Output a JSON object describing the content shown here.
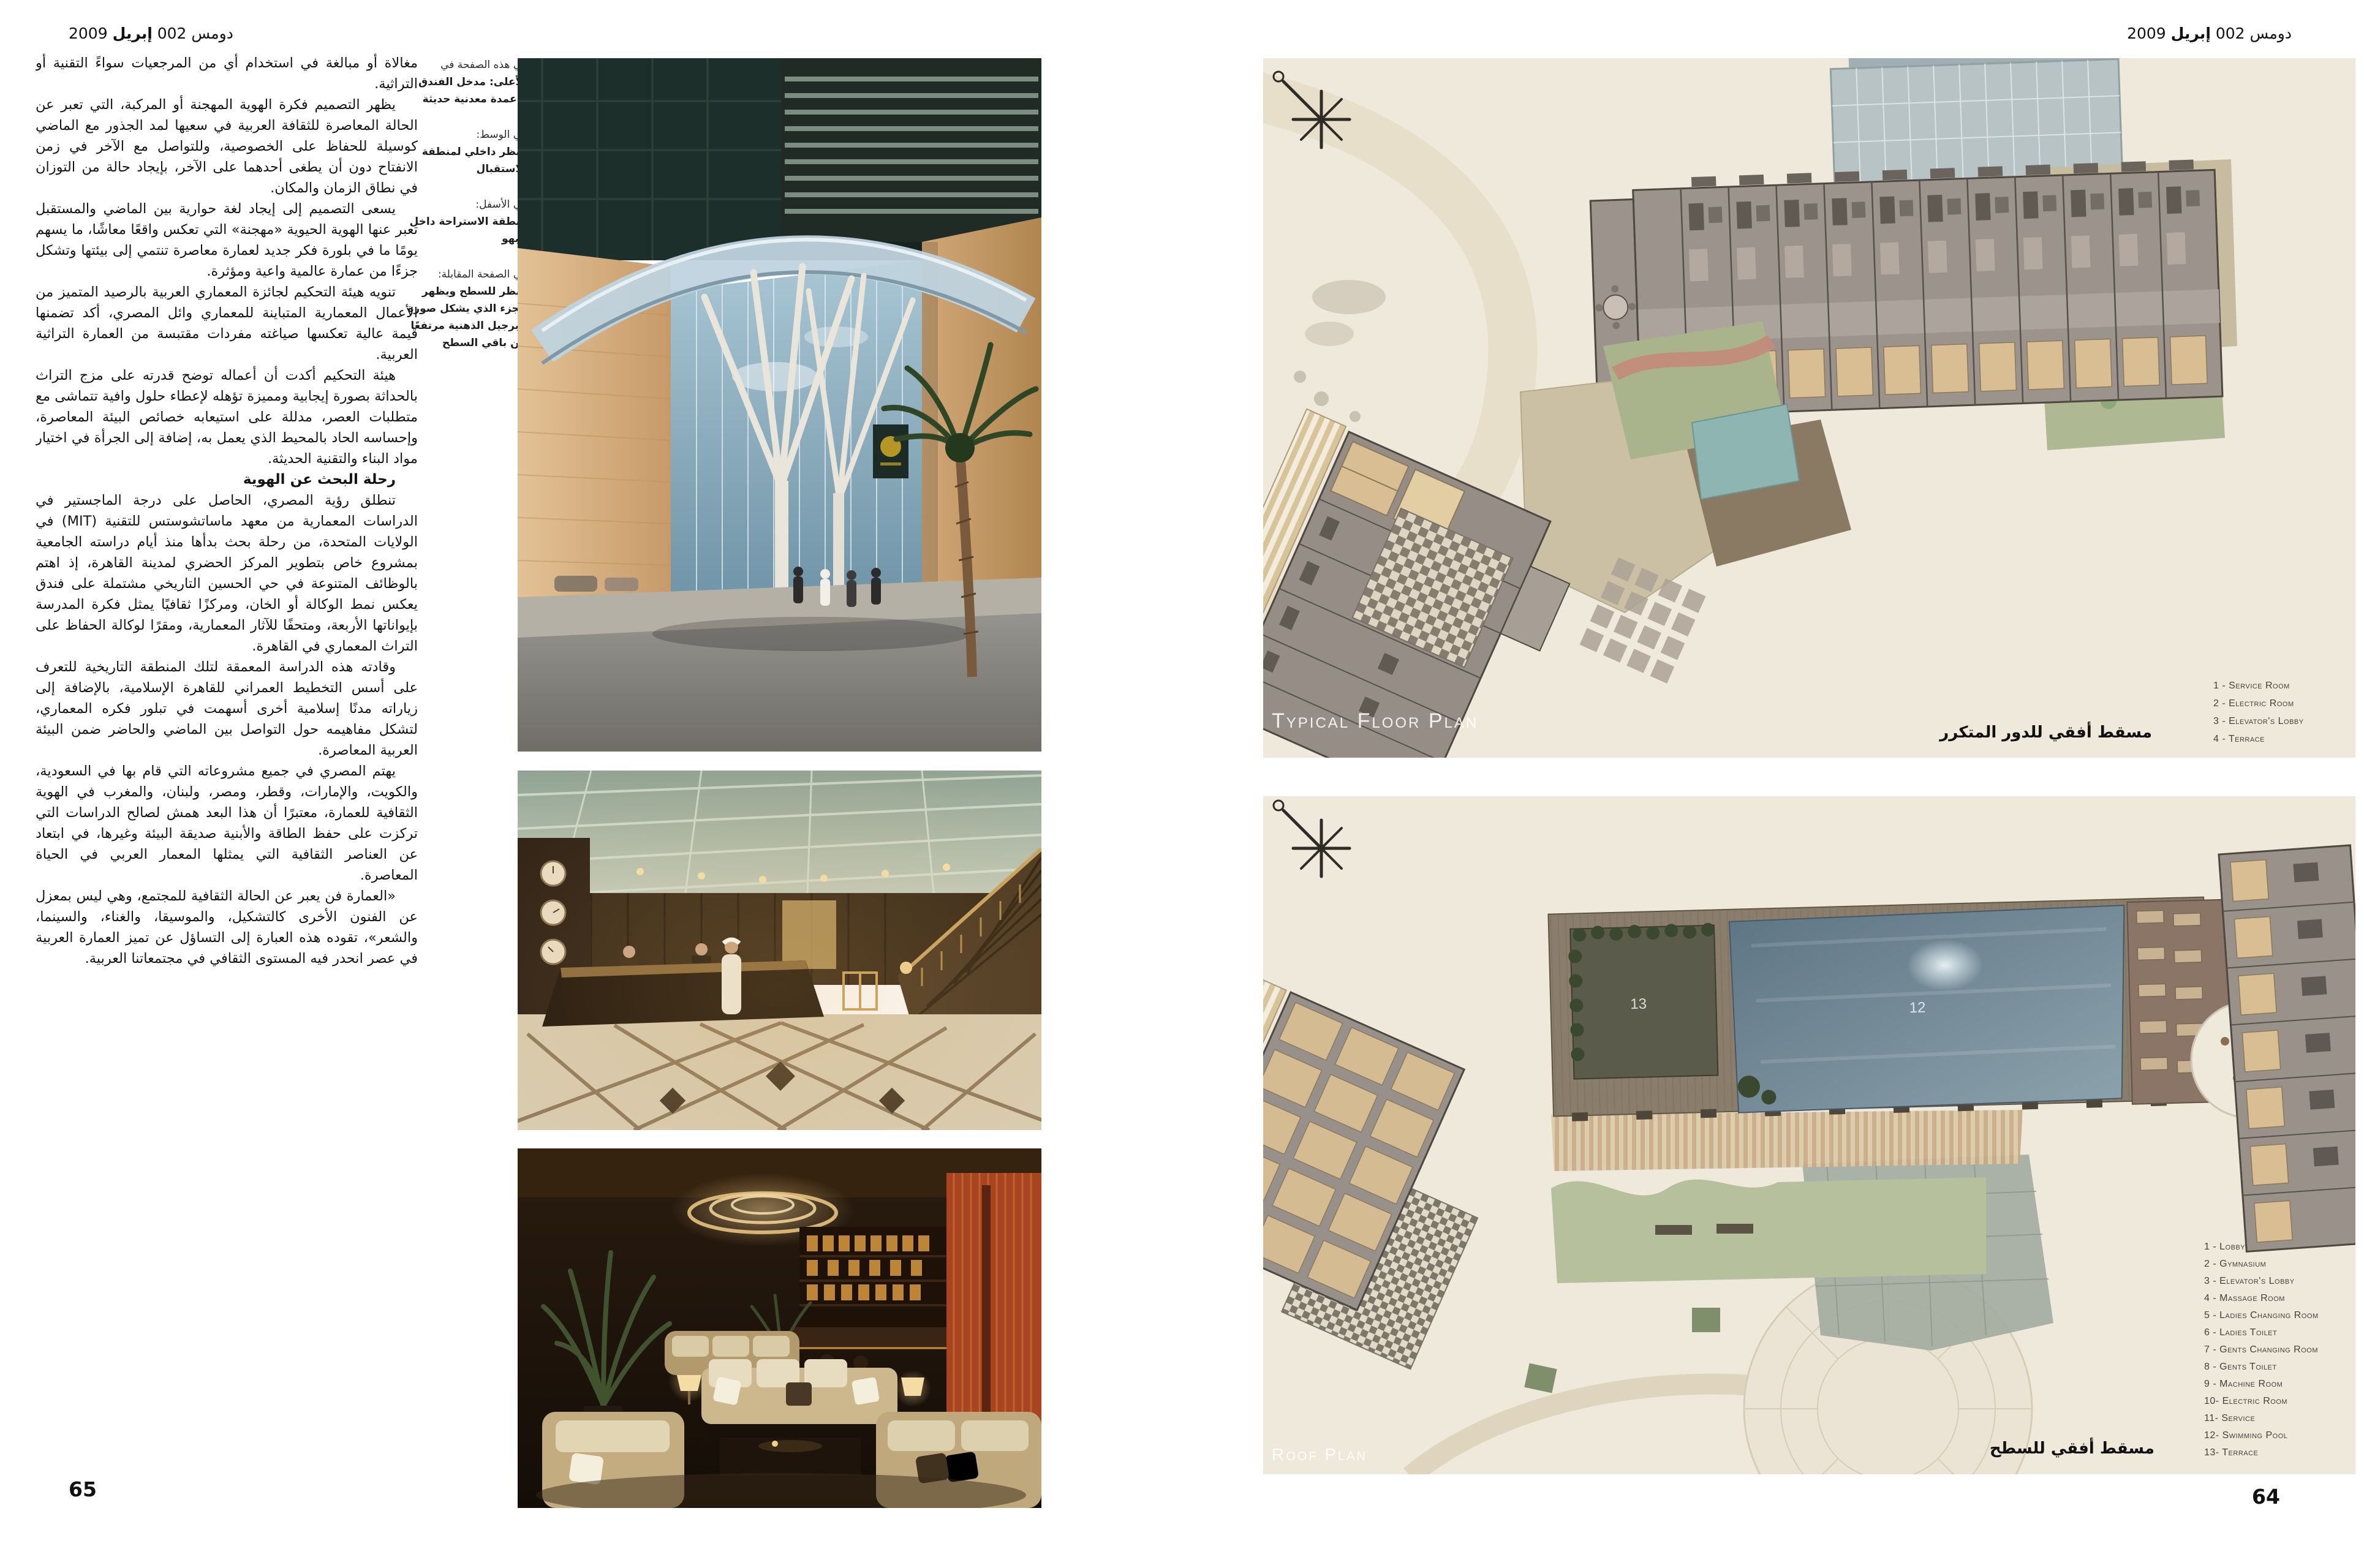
{
  "page": {
    "header": {
      "brand": "دومس",
      "issue": "002",
      "month": "إبريل",
      "year": "2009"
    },
    "left_page_number": "65",
    "right_page_number": "64"
  },
  "article": {
    "intro_paragraphs": [
      "مغالاة أو مبالغة في استخدام أي من المرجعيات سواءً التقنية أو التراثية.",
      "يظهر التصميم فكرة الهوية المهجنة أو المركبة، التي تعبر عن الحالة المعاصرة للثقافة العربية في سعيها لمد الجذور مع الماضي كوسيلة للحفاظ على الخصوصية، وللتواصل مع الآخر في زمن الانفتاح دون أن يطغى أحدهما على الآخر، بإيجاد حالة من التوزان في نطاق الزمان والمكان.",
      "يسعى التصميم إلى إيجاد لغة حوارية بين الماضي والمستقبل تعبر عنها الهوية الحيوية «مهجنة» التي تعكس واقعًا معاشًا، ما يسهم يومًا ما في بلورة فكر جديد لعمارة معاصرة تنتمي إلى بيئتها وتشكل جزءًا من عمارة عالمية واعية ومؤثرة.",
      "تنويه هيئة التحكيم لجائزة المعماري العربية بالرصيد المتميز من الأعمال المعمارية المتباينة للمعماري وائل المصري، أكد تضمنها قيمة عالية تعكسها صياغته مفردات مقتبسة من العمارة التراثية العربية.",
      "هيئة التحكيم أكدت أن أعماله توضح قدرته على مزج التراث بالحداثة بصورة إيجابية ومميزة تؤهله لإعطاء حلول وافية تتماشى مع متطلبات العصر، مدللة على استيعابه خصائص البيئة المعاصرة، وإحساسه الحاد بالمحيط الذي يعمل به، إضافة إلى الجرأة في اختيار مواد البناء والتقنية الحديثة."
    ],
    "section_heading": "رحلة البحث عن الهوية",
    "body_paragraphs": [
      "تنطلق رؤية المصري، الحاصل على درجة الماجستير في الدراسات المعمارية من معهد ماساتشوستس للتقنية (MIT) في الولايات المتحدة، من رحلة بحث بدأها منذ أيام دراسته الجامعية بمشروع خاص بتطوير المركز الحضري لمدينة القاهرة، إذ اهتم بالوظائف المتنوعة في حي الحسين التاريخي مشتملة على فندق يعكس نمط الوكالة أو الخان، ومركزًا ثقافيًا يمثل فكرة المدرسة بإيواناتها الأربعة، ومتحفًا للآثار المعمارية، ومقرًا لوكالة الحفاظ على التراث المعماري في القاهرة.",
      "وقادته هذه الدراسة المعمقة لتلك المنطقة التاريخية للتعرف على أسس التخطيط العمراني للقاهرة الإسلامية، بالإضافة إلى زياراته مدنًا إسلامية أخرى أسهمت في تبلور فكره المعماري، لتشكل مفاهيمه حول التواصل بين الماضي والحاضر ضمن البيئة العربية المعاصرة.",
      "يهتم المصري في جميع مشروعاته التي قام بها في السعودية، والكويت، والإمارات، وقطر، ومصر، ولبنان، والمغرب في الهوية الثقافية للعمارة، معتبرًا أن هذا البعد همش لصالح الدراسات التي تركزت على حفظ الطاقة والأبنية صديقة البيئة وغيرها، في ابتعاد عن العناصر الثقافية التي يمثلها المعمار العربي في الحياة المعاصرة.",
      "«العمارة فن يعبر عن الحالة الثقافية للمجتمع، وهي ليس بمعزل عن الفنون الأخرى كالتشكيل، والموسيقا، والغناء، والسينما، والشعر»، تقوده هذه العبارة إلى التساؤل عن تميز العمارة العربية في عصر انحدر فيه المستوى الثقافي في مجتمعاتنا العربية."
    ]
  },
  "captions": {
    "blocks": [
      {
        "intro": "في هذه الصفحة في",
        "text": "الأعلى: مدخل الفندق وأعمدة معدنية حديثة"
      },
      {
        "intro": "في الوسط:",
        "text": "منظر داخلي لمنطقة الاستقبال"
      },
      {
        "intro": "في الأسفل:",
        "text": "منطقة الاستراحة داخل البهو"
      },
      {
        "intro": "في الصفحة المقابلة:",
        "text": "منظر للسطح ويظهر الجزء الذي يشكل صورة البرجيل الذهنية مرتفعًا عن باقي السطح"
      }
    ]
  },
  "plan_typical": {
    "label": "Typical Floor Plan",
    "legend": [
      "1 - Service Room",
      "2 - Electric Room",
      "3 - Elevator's Lobby",
      "4 - Terrace"
    ],
    "caption_ar": "مسقط أفقي للدور المتكرر"
  },
  "plan_roof": {
    "label": "Roof Plan",
    "legend": [
      "1 - Lobby",
      "2 - Gymnasium",
      "3 - Elevator's Lobby",
      "4 - Massage Room",
      "5 - Ladies Changing Room",
      "6 - Ladies Toilet",
      "7 - Gents Changing Room",
      "8 - Gents Toilet",
      "9 - Machine Room",
      "10- Electric Room",
      "11- Service",
      "12- Swimming Pool",
      "13- Terrace"
    ],
    "caption_ar": "مسقط أفقي للسطح",
    "pool_marker": "12",
    "terrace_marker": "13"
  },
  "colors": {
    "page_background": "#ffffff",
    "text": "#1a1a1a",
    "plan_background": "#efe9dc",
    "pool_teal": "#8fb5b2",
    "roof_pool_blue": "#5e7584",
    "accent_tan": "#d9be93"
  }
}
